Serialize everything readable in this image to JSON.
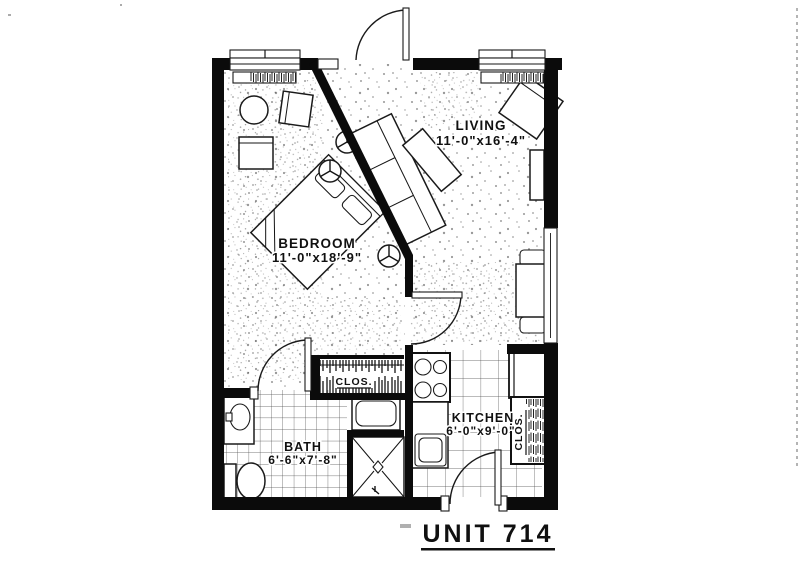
{
  "title": {
    "text": "UNIT 714"
  },
  "rooms": {
    "living": {
      "name": "LIVING",
      "dims": "11'-0\"x16'-4\""
    },
    "bedroom": {
      "name": "BEDROOM",
      "dims": "11'-0\"x18'-9\""
    },
    "bath": {
      "name": "BATH",
      "dims": "6'-6\"x7'-8\""
    },
    "kitchen": {
      "name": "KITCHEN",
      "dims": "6'-0\"x9'-0\""
    }
  },
  "closets": {
    "hall": "CLOS.",
    "pantry": "CLOS."
  },
  "colors": {
    "ink": "#101010",
    "paper": "#ffffff"
  }
}
